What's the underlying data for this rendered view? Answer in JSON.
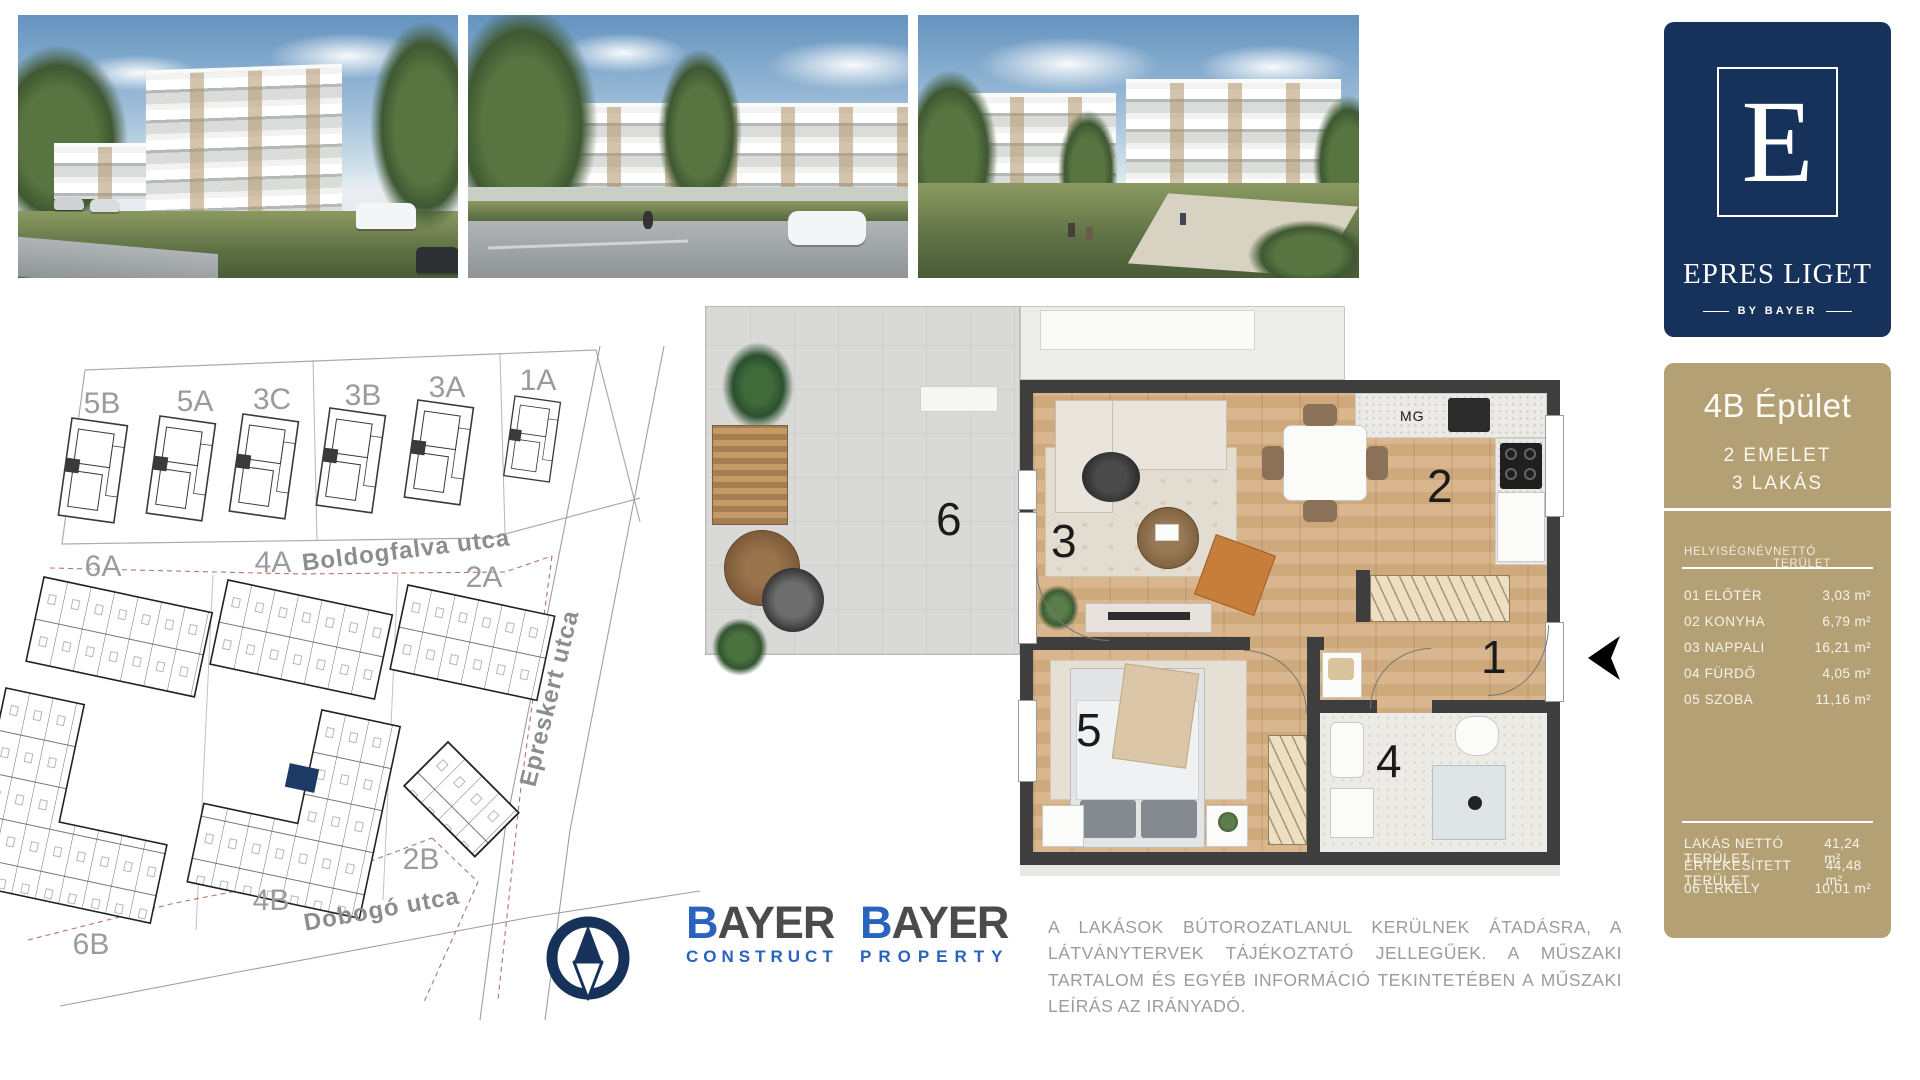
{
  "brand": {
    "logo_letter": "E",
    "logo_name": "EPRES LIGET",
    "logo_byline": "BY BAYER"
  },
  "colors": {
    "navy": "#16325a",
    "tan": "#b3a075",
    "bayer_blue": "#2a63bd",
    "highlight_unit": "#1d3a66",
    "wall": "#3e3e3e"
  },
  "site_plan": {
    "streets": {
      "boldogfalva": "Boldogfalva utca",
      "epreskert": "Epreskert utca",
      "dobogo": "Dobogó utca"
    },
    "buildings": {
      "b5b": "5B",
      "b5a": "5A",
      "b3c": "3C",
      "b3b": "3B",
      "b3a": "3A",
      "b1a": "1A",
      "b6a": "6A",
      "b4a": "4A",
      "b2a": "2A",
      "b2b": "2B",
      "b4b": "4B",
      "b6b": "6B"
    }
  },
  "floor_plan": {
    "appliance_label": "MG",
    "rooms": {
      "n1": "1",
      "n2": "2",
      "n3": "3",
      "n4": "4",
      "n5": "5",
      "n6": "6"
    }
  },
  "info_panel": {
    "title": "4B Épület",
    "subtitle_floor": "2 EMELET",
    "subtitle_units": "3 LAKÁS",
    "table": {
      "header_name": "HELYISÉGNÉV",
      "header_area": "NETTÓ TERÜLET",
      "rows": [
        {
          "name": "01 ELŐTÉR",
          "area": "3,03 m²"
        },
        {
          "name": "02 KONYHA",
          "area": "6,79 m²"
        },
        {
          "name": "03 NAPPALI",
          "area": "16,21 m²"
        },
        {
          "name": "04 FÜRDŐ",
          "area": "4,05 m²"
        },
        {
          "name": "05 SZOBA",
          "area": "11,16 m²"
        }
      ],
      "summary": [
        {
          "name": "LAKÁS NETTÓ TERÜLET",
          "area": "41,24 m²"
        },
        {
          "name": "ÉRTÉKESÍTETT TERÜLET",
          "area": "44,48 m²"
        },
        {
          "name": "06 ERKÉLY",
          "area": "10,01 m²"
        }
      ]
    }
  },
  "logos": {
    "construct": {
      "b": "B",
      "rest": "AYER",
      "sub": "CONSTRUCT"
    },
    "property": {
      "b": "B",
      "rest": "AYER",
      "sub": "PROPERTY"
    }
  },
  "disclaimer": "A LAKÁSOK BÚTOROZATLANUL KERÜLNEK ÁTADÁSRA, A LÁTVÁNYTERVEK TÁJÉKOZTATÓ JELLEGŰEK. A MŰSZAKI TARTALOM ÉS EGYÉB INFORMÁCIÓ TEKINTETÉBEN A MŰSZAKI LEÍRÁS AZ IRÁNYADÓ."
}
